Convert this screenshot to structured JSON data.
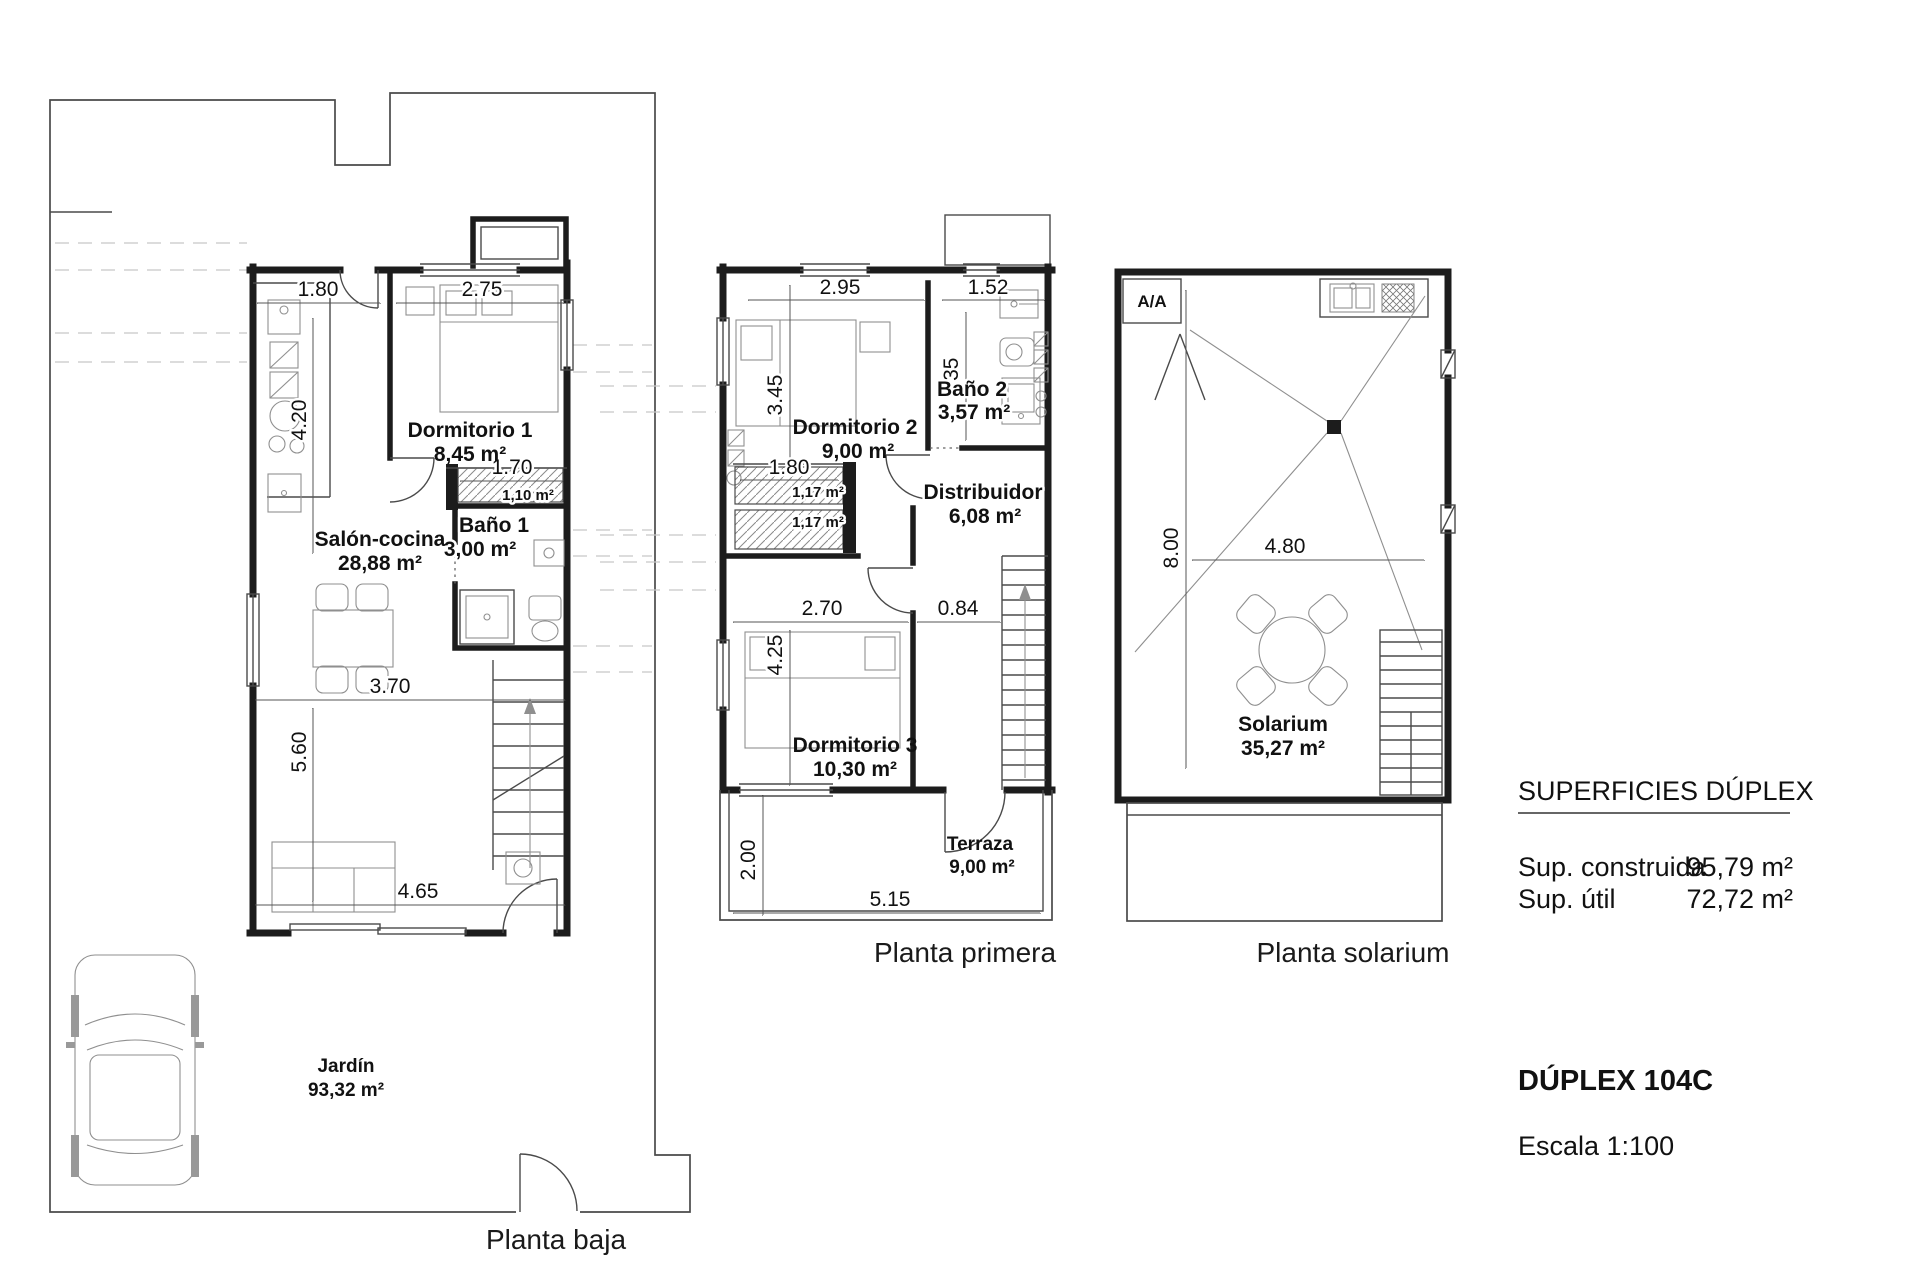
{
  "page": {
    "background": "#ffffff",
    "wall_color": "#1c1c1c"
  },
  "baja": {
    "title": "Planta baja",
    "salon_name": "Salón-cocina",
    "salon_area": "28,88 m²",
    "dorm1_name": "Dormitorio 1",
    "dorm1_area": "8,45 m²",
    "bano1_name": "Baño 1",
    "bano1_area": "3,00 m²",
    "armario_area": "1,10 m²",
    "jardin_name": "Jardín",
    "jardin_area": "93,32 m²",
    "dims": {
      "d1": "1.80",
      "d2": "2.75",
      "d3": "4.20",
      "d4": "1.70",
      "d5": "3.70",
      "d6": "5.60",
      "d7": "4.65"
    }
  },
  "primera": {
    "title": "Planta primera",
    "dorm2_name": "Dormitorio 2",
    "dorm2_area": "9,00 m²",
    "bano2_name": "Baño 2",
    "bano2_area": "3,57 m²",
    "distribuidor_name": "Distribuidor",
    "distribuidor_area": "6,08 m²",
    "dorm3_name": "Dormitorio 3",
    "dorm3_area": "10,30 m²",
    "terraza_name": "Terraza",
    "terraza_area": "9,00 m²",
    "armario1_area": "1,17 m²",
    "armario2_area": "1,17 m²",
    "dims": {
      "d1": "2.95",
      "d2": "1.52",
      "d3": "2.35",
      "d4": "3.45",
      "d5": "1.80",
      "d6": "2.70",
      "d7": "0.84",
      "d8": "4.25",
      "d9": "2.00",
      "d10": "5.15"
    }
  },
  "solarium": {
    "title": "Planta solarium",
    "room_name": "Solarium",
    "room_area": "35,27 m²",
    "ac_label": "A/A",
    "dims": {
      "d1": "8.00",
      "d2": "4.80"
    }
  },
  "legend": {
    "superficies_title": "SUPERFICIES DÚPLEX",
    "construida_label": "Sup. construida",
    "construida_value": "95,79 m²",
    "util_label": "Sup. útil",
    "util_value": "72,72 m²",
    "duplex_title": "DÚPLEX 104C",
    "escala_label": "Escala 1:100"
  }
}
